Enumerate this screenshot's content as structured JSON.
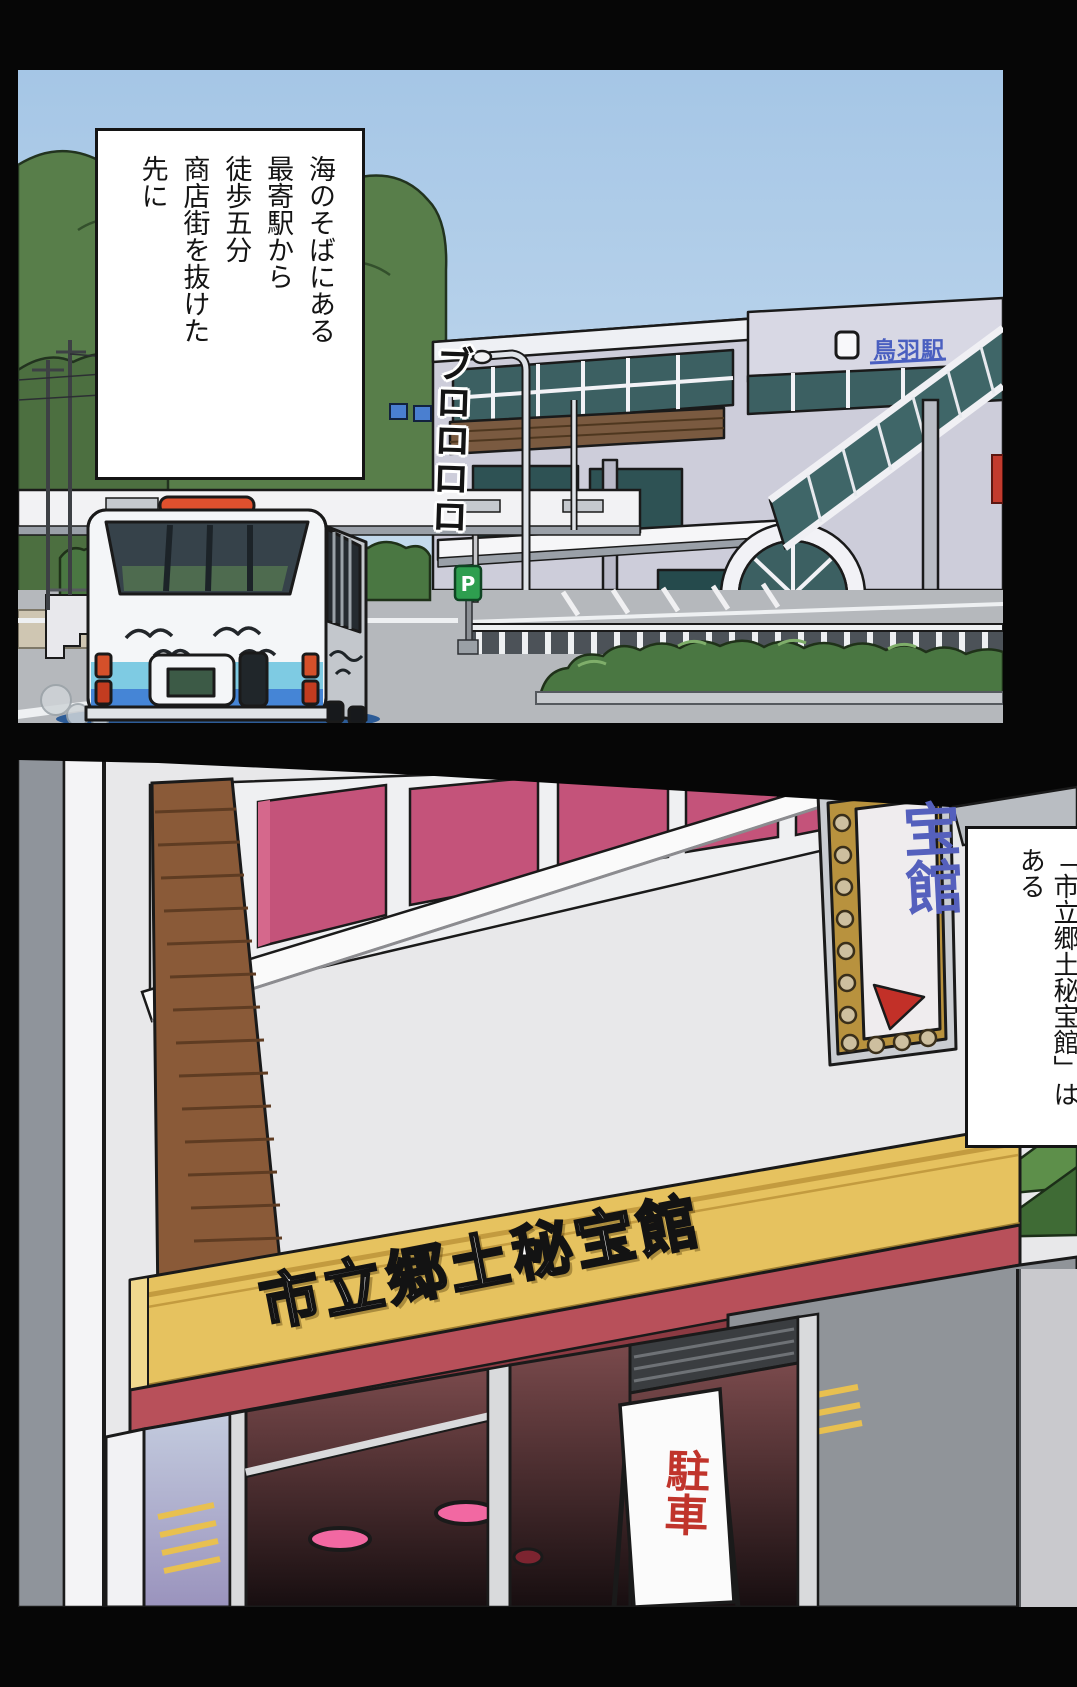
{
  "page": {
    "background": "#060606"
  },
  "panel1": {
    "caption": "海のそばにある\n最寄駅から\n徒歩五分\n商店街を抜けた\n先に",
    "sfx": "ブロロロロ",
    "station_sign": "鳥羽駅",
    "parking_sign_letter": "P",
    "colors": {
      "sky_top": "#a5c6e6",
      "sky_bottom": "#cfe1f0",
      "tree_green": "#587e4a",
      "station_wall": "#cdcdda",
      "glass_teal": "#3c6062",
      "road": "#b5b8bc",
      "bus_body": "#f4f6f8",
      "bus_band_light": "#7ecbe3",
      "bus_band_blue": "#4585d6",
      "taillight": "#d4502a",
      "hedge": "#4a7742"
    }
  },
  "panel2": {
    "banner": "市立郷土秘宝館",
    "caption": "「市立郷土秘宝館」は\nある",
    "standing_sign": "駐車",
    "vertical_sign": "宝館",
    "colors": {
      "banner_yellow": "#e6c25f",
      "fascia_red": "#b8505a",
      "window_pink": "#c4537a",
      "sign_blue": "#5560bd",
      "wall_gray": "#e8e8ea",
      "brick_brown": "#8a5a38",
      "interior_maroon": "#7a4a4c",
      "light_pink": "#f268a2"
    }
  }
}
